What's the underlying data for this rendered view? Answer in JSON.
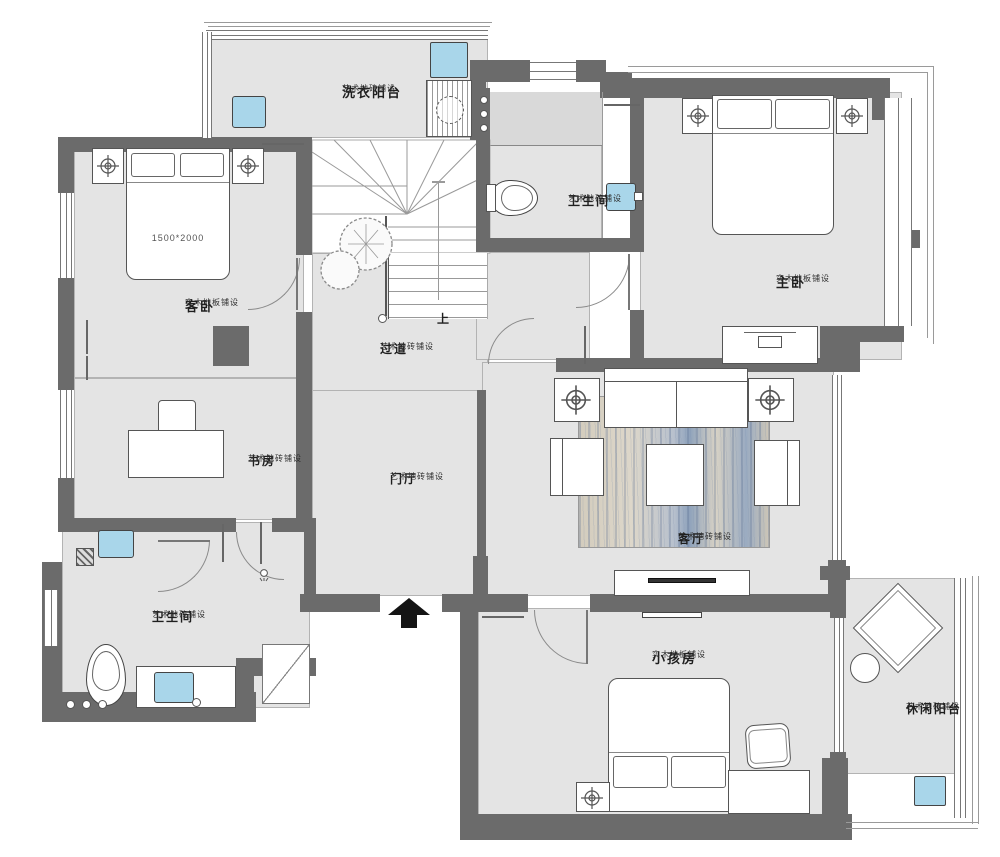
{
  "plan": {
    "rooms": {
      "laundry_balcony": {
        "name": "洗衣阳台",
        "note": "艺术地砖铺设"
      },
      "bath_top": {
        "name": "卫生间",
        "note": "艺术地砖铺设"
      },
      "master_bedroom": {
        "name": "主卧",
        "note": "实木地板铺设"
      },
      "guest_bedroom": {
        "name": "客卧",
        "note": "实木地板铺设",
        "bed_size": "1500*2000"
      },
      "corridor": {
        "name": "过道",
        "note": "艺术地砖铺设"
      },
      "study": {
        "name": "书房",
        "note": "艺术地砖铺设"
      },
      "foyer": {
        "name": "门厅",
        "note": "艺术地砖铺设"
      },
      "living_room": {
        "name": "客厅",
        "note": "艺术地砖铺设"
      },
      "bath_bottom": {
        "name": "卫生间",
        "note": "艺术地砖铺设"
      },
      "kids_room": {
        "name": "小孩房",
        "note": "实木地板铺设"
      },
      "leisure_balcony": {
        "name": "休闲阳台",
        "note": "艺术地砖铺设"
      }
    },
    "stairs": {
      "direction_label": "上"
    },
    "colors": {
      "wall": "#6b6b6b",
      "floor": "#e4e4e4",
      "fixture_blue": "#a9d6ea",
      "rug_beige": "#d6cfc0",
      "rug_blue": "#8ca0b8"
    }
  }
}
